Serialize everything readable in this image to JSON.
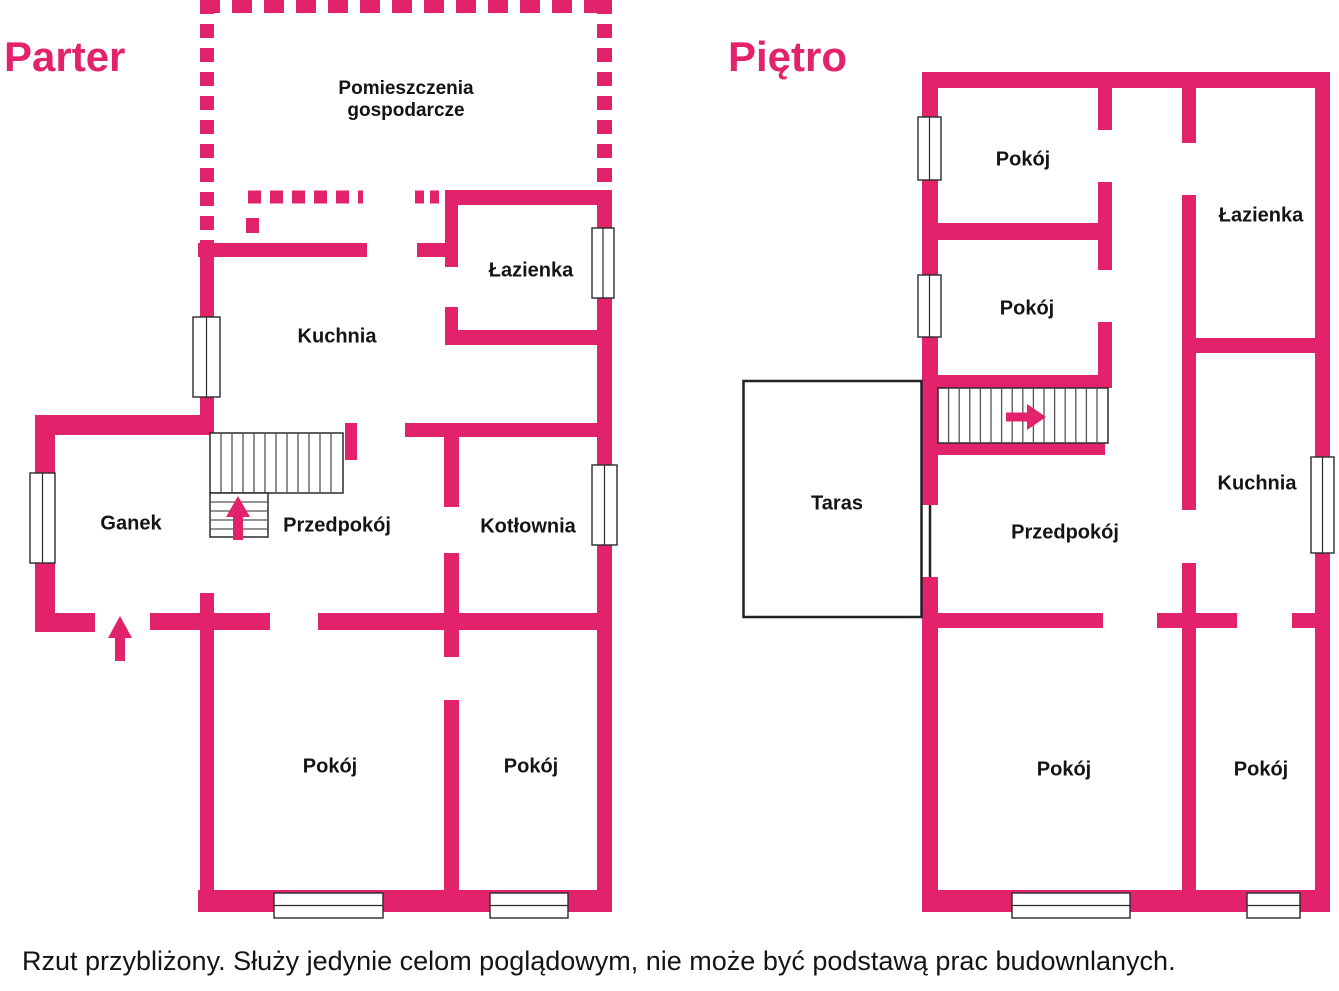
{
  "colors": {
    "walls": "#E2226A",
    "text": "#141414",
    "outline": "#2b2b2b"
  },
  "parter": {
    "title": "Parter",
    "rooms": {
      "pomieszczenia_line1": "Pomieszczenia",
      "pomieszczenia_line2": "gospodarcze",
      "lazienka": "Łazienka",
      "kuchnia": "Kuchnia",
      "ganek": "Ganek",
      "przedpokoj": "Przedpokój",
      "kotlownia": "Kotłownia",
      "pokoj_lewy": "Pokój",
      "pokoj_prawy": "Pokój"
    }
  },
  "pietro": {
    "title": "Piętro",
    "rooms": {
      "pokoj_gorny": "Pokój",
      "lazienka": "Łazienka",
      "pokoj_srodkowy": "Pokój",
      "taras": "Taras",
      "kuchnia": "Kuchnia",
      "przedpokoj": "Przedpokój",
      "pokoj_lewy": "Pokój",
      "pokoj_prawy": "Pokój"
    }
  },
  "caption": "Rzut przybliżony. Służy jedynie celom poglądowym, nie może być podstawą prac budownlanych."
}
